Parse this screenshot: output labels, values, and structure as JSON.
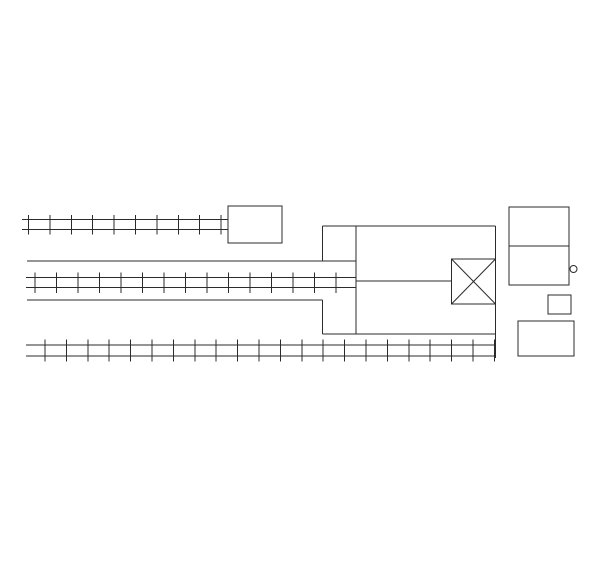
{
  "canvas": {
    "width": 600,
    "height": 569,
    "background_color": "#ffffff",
    "line_color": "#2b2b2b",
    "line_width": 1
  },
  "diagram": {
    "tracks": [
      {
        "name": "track-top",
        "x1": 22,
        "x2": 228,
        "rail_y1": 219.5,
        "rail_y2": 229.5,
        "tie_y1": 215,
        "tie_y2": 234.5,
        "tie_start_x": 28.5,
        "tie_spacing": 21.4,
        "tie_count": 10
      },
      {
        "name": "track-middle",
        "x1": 26,
        "x2": 356,
        "rail_y1": 277.5,
        "rail_y2": 287.5,
        "tie_y1": 272.5,
        "tie_y2": 293,
        "tie_start_x": 35,
        "tie_spacing": 21.5,
        "tie_count": 15
      },
      {
        "name": "track-bottom",
        "x1": 26,
        "x2": 495.5,
        "rail_y1": 345,
        "rail_y2": 356,
        "tie_y1": 339.5,
        "tie_y2": 361.5,
        "tie_start_x": 45,
        "tie_spacing": 21.4,
        "tie_count": 22
      }
    ],
    "lines": [
      {
        "name": "corridor-top-line",
        "x1": 27,
        "y1": 261,
        "x2": 356,
        "y2": 261
      },
      {
        "name": "corridor-bottom-line",
        "x1": 27,
        "y1": 300,
        "x2": 322.5,
        "y2": 300
      },
      {
        "name": "center-feed-line",
        "x1": 356,
        "y1": 281,
        "x2": 451.5,
        "y2": 281
      },
      {
        "name": "structure-top-edge",
        "x1": 322.5,
        "y1": 226,
        "x2": 495.5,
        "y2": 226
      },
      {
        "name": "structure-bottom-edge",
        "x1": 322.5,
        "y1": 334,
        "x2": 495.5,
        "y2": 334
      },
      {
        "name": "structure-right-edge",
        "x1": 495.5,
        "y1": 226,
        "x2": 495.5,
        "y2": 358
      },
      {
        "name": "structure-left-edge-upper",
        "x1": 322.5,
        "y1": 226,
        "x2": 322.5,
        "y2": 261
      },
      {
        "name": "structure-left-edge-lower",
        "x1": 322.5,
        "y1": 300,
        "x2": 322.5,
        "y2": 334
      },
      {
        "name": "structure-inner-wall",
        "x1": 356,
        "y1": 226,
        "x2": 356,
        "y2": 334
      }
    ],
    "rects": [
      {
        "name": "building-top",
        "x": 228,
        "y": 206,
        "w": 54,
        "h": 37
      },
      {
        "name": "building-right",
        "x": 509,
        "y": 207,
        "w": 60,
        "h": 78,
        "divider_y": 246
      },
      {
        "name": "building-small",
        "x": 548,
        "y": 295,
        "w": 23,
        "h": 19
      },
      {
        "name": "building-bottom-right",
        "x": 518,
        "y": 321,
        "w": 56,
        "h": 35
      }
    ],
    "crossed_box": {
      "name": "crossing-box",
      "x": 451.5,
      "y": 259,
      "w": 44,
      "h": 45
    },
    "circle": {
      "name": "detail-circle",
      "cx": 573.5,
      "cy": 269,
      "r": 3.5
    }
  }
}
